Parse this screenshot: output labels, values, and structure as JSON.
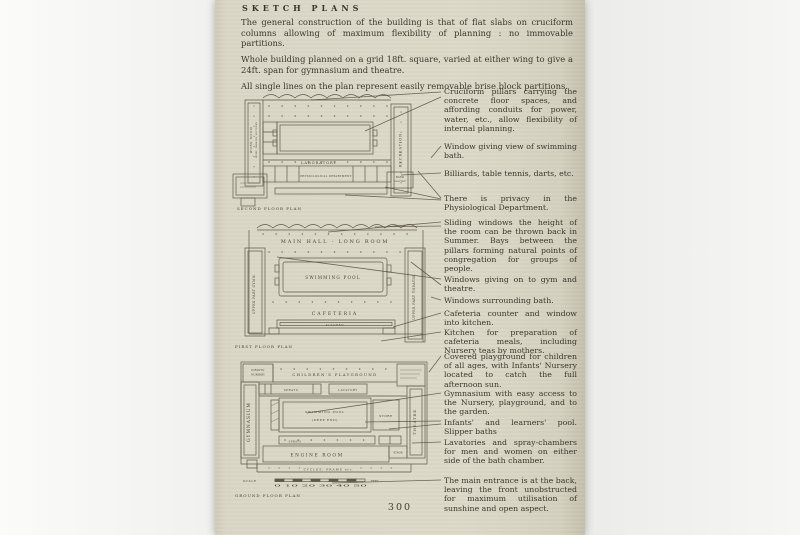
{
  "colors": {
    "paper": "#dcd9c9",
    "ink": "#4a4434"
  },
  "page": {
    "title": "SKETCH PLANS",
    "intro": [
      "The general construction of the building is that of flat slabs on cruciform columns allowing of maximum flexibility of planning :  no immovable partitions.",
      "Whole building planned on a grid 18ft. square, varied at either wing to give a 24ft. span for gymnasium and theatre.",
      "All single lines on the plan represent easily removable brise block partitions."
    ],
    "page_number": "300"
  },
  "plans": {
    "second": {
      "caption": "SECOND FLOOR PLAN",
      "left_wing_line1": "WORK ROOM",
      "left_wing_line2": "MUSIC, DEBATES, LECTURES",
      "right_wing": "RECREATION",
      "laboratory": "LABORATORY",
      "department": "PHYSIOLOGICAL DEPARTMENT",
      "band_line1": "BAND",
      "band_line2": "PRACTICE"
    },
    "first": {
      "caption": "FIRST FLOOR PLAN",
      "main_hall": "MAIN HALL - LONG ROOM",
      "swimming_pool": "SWIMMING POOL",
      "cafeteria": "CAFETERIA",
      "kitchen": "KITCHEN",
      "left_wing": "UPPER PART GYMN.",
      "right_wing": "UPPER PART THEATRE"
    },
    "ground": {
      "caption": "GROUND FLOOR PLAN",
      "nursery_line1": "INFANTS'",
      "nursery_line2": "NURSERY",
      "playground": "CHILDREN'S PLAYGROUND",
      "sprays_top": "SPRAYS",
      "lavatory": "LAVATORY",
      "pool_line1": "SWIMMING POOL",
      "pool_line2": "(DEEP END)",
      "store": "STORE",
      "gymnasium": "GYMNASIUM",
      "theatre": "THEATRE",
      "sprays_bottom": "SPRAYS",
      "engine_room": "ENGINE ROOM",
      "stage": "STAGE",
      "cycles": "CYCLES, PRAMS etc.",
      "scale_label": "SCALE",
      "scale_numbers": "0  10  20  30  40  50",
      "scale_unit": "FEET"
    }
  },
  "notes": [
    "Cruciform pillars carrying the concrete floor spaces, and affording conduits for power, water, etc., allow flexibility of internal planning.",
    "Window giving view of swimming bath.",
    "Billiards, table tennis, darts, etc.",
    "There is privacy in the Physiological Department.",
    "Sliding windows the height of the room can be thrown back in Summer.  Bays between the pillars forming natural points of congregation for groups of people.",
    "Windows giving on to gym and theatre.",
    "Windows surrounding bath.",
    "Cafeteria counter and window into kitchen.",
    "Kitchen for preparation of cafeteria meals, including Nursery teas by mothers.",
    "Covered playground for children of all ages, with Infants' Nursery located to catch the full afternoon sun.",
    "Gymnasium with easy access to the Nursery, playground, and to the garden.",
    "Infants' and learners' pool. Slipper baths",
    "Lavatories and spray-chambers for men and women on either side of the bath chamber.",
    "The main entrance is at the back, leaving the front unobstructed for maximum utilisation of sunshine and open aspect."
  ]
}
